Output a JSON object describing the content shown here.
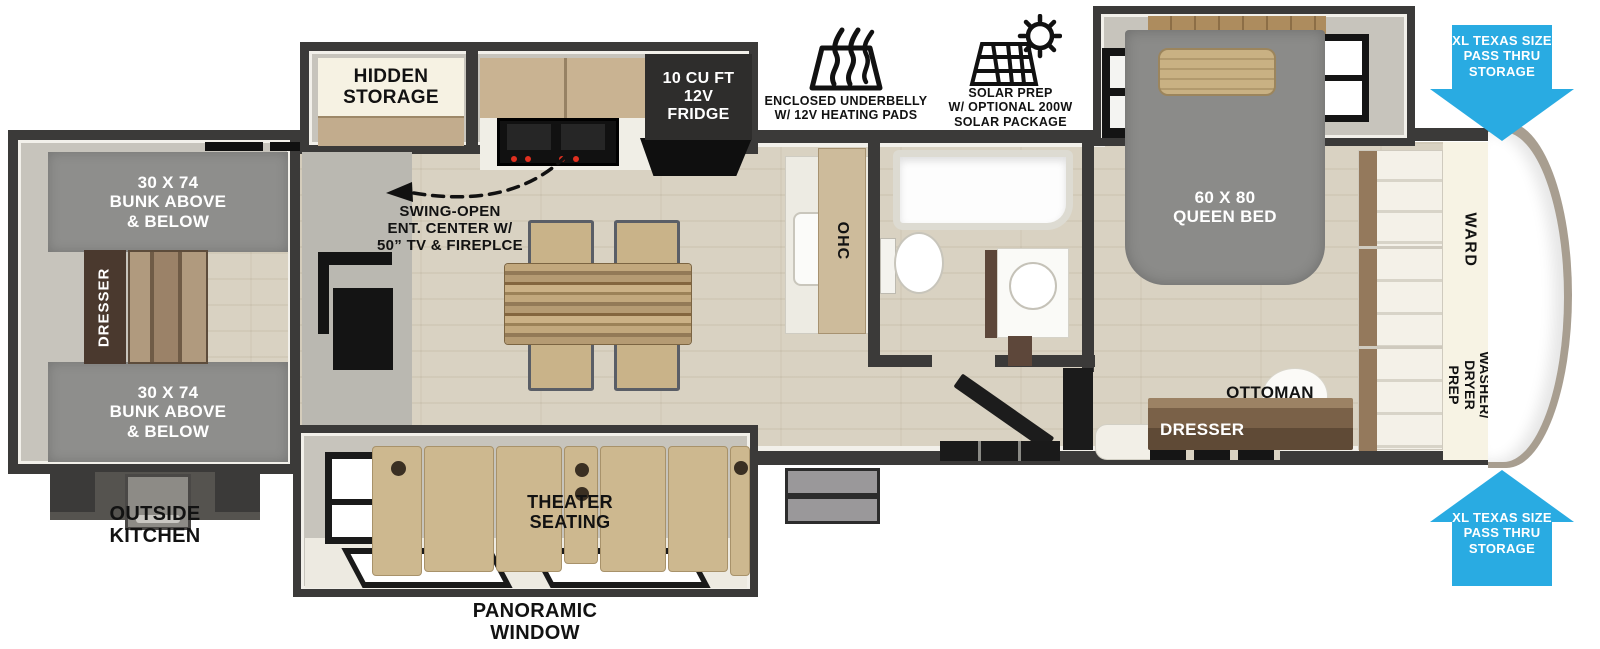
{
  "plan": {
    "type": "fifth-wheel RV floor plan",
    "labels": {
      "hidden_storage": "HIDDEN\nSTORAGE",
      "fridge": "10 CU FT\n12V\nFRIDGE",
      "underbelly_caption": "ENCLOSED UNDERBELLY\nW/ 12V HEATING PADS",
      "solar_caption": "SOLAR PREP\nW/ OPTIONAL 200W\nSOLAR PACKAGE",
      "pass_thru_top": "XL TEXAS SIZE\nPASS THRU\nSTORAGE",
      "pass_thru_bottom": "XL TEXAS SIZE\nPASS THRU\nSTORAGE",
      "bunk_top": "30 X 74\nBUNK ABOVE\n& BELOW",
      "bunk_bottom": "30 X 74\nBUNK ABOVE\n& BELOW",
      "dresser_bunk": "DRESSER",
      "swing_open": "SWING-OPEN\nENT. CENTER W/\n50” TV & FIREPLCE",
      "ohc": "OHC",
      "queen_bed": "60 X 80\nQUEEN BED",
      "ottoman": "OTTOMAN",
      "dresser_bedroom": "DRESSER",
      "ward": "WARD",
      "washer_dryer": "WASHER/\nDRYER\nPREP",
      "outside_kitchen": "OUTSIDE\nKITCHEN",
      "theater_seating": "THEATER\nSEATING",
      "panoramic_window": "PANORAMIC\nWINDOW"
    },
    "icons": [
      "heating-pads-icon",
      "solar-panel-icon"
    ],
    "colors": {
      "accent_blue": "#29abe2",
      "wall_dark": "#3b3a39",
      "floor_wood": "#d9d2c2",
      "slide_wall_gray": "#c7c4bc",
      "bunk_gray": "#8e8e8c",
      "bed_gray": "#8b8b89",
      "cream": "#f6f2e3",
      "sofa_tan": "#cdb88f",
      "cabinet_wood": "#c9b392",
      "dresser_brown": "#6e5843",
      "black_appliance": "#151515"
    }
  }
}
